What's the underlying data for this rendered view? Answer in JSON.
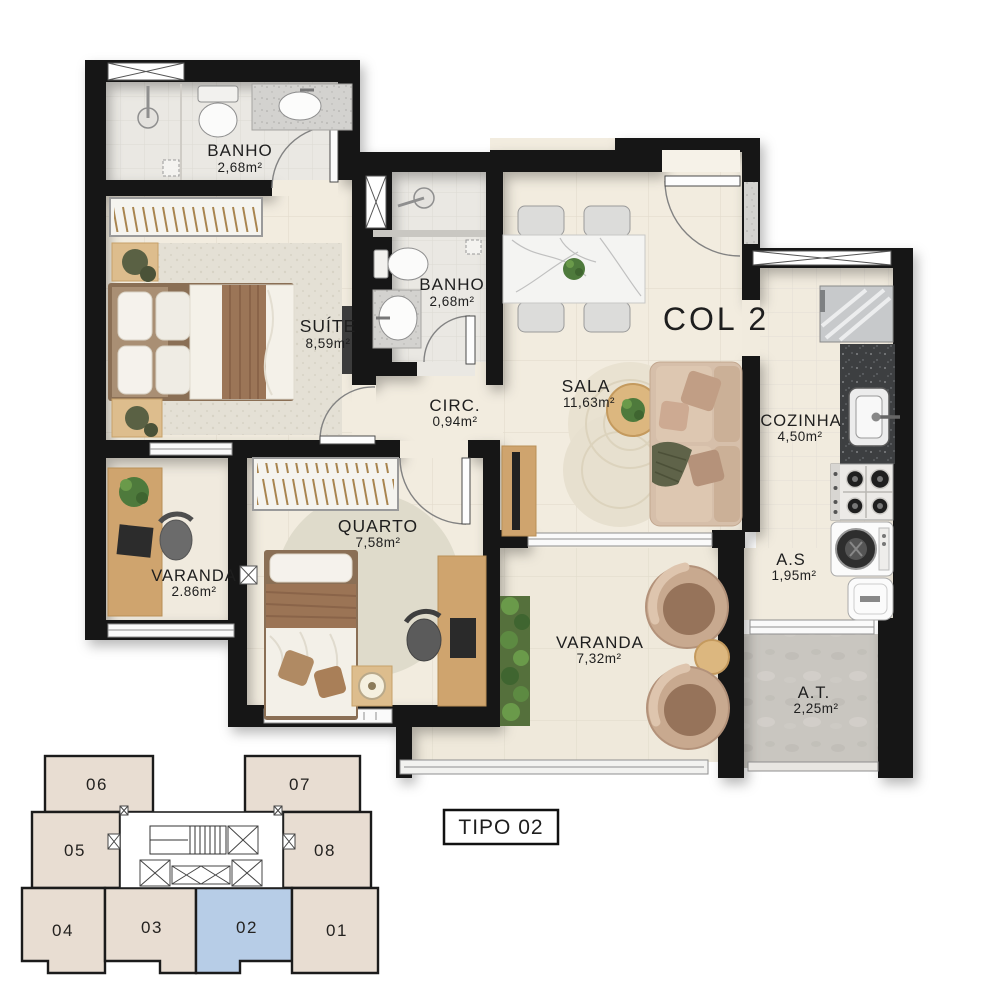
{
  "plan": {
    "type_label": "TIPO 02",
    "column_label": "COL 2",
    "rooms": [
      {
        "name": "BANHO",
        "area": "2,68m²"
      },
      {
        "name": "SUÍTE",
        "area": "8,59m²"
      },
      {
        "name": "BANHO",
        "area": "2,68m²"
      },
      {
        "name": "CIRC.",
        "area": "0,94m²"
      },
      {
        "name": "SALA",
        "area": "11,63m²"
      },
      {
        "name": "COZINHA",
        "area": "4,50m²"
      },
      {
        "name": "VARANDA",
        "area": "2.86m²"
      },
      {
        "name": "QUARTO",
        "area": "7,58m²"
      },
      {
        "name": "VARANDA",
        "area": "7,32m²"
      },
      {
        "name": "A.S",
        "area": "1,95m²"
      },
      {
        "name": "A.T.",
        "area": "2,25m²"
      }
    ]
  },
  "key_plan": {
    "units": [
      {
        "label": "06"
      },
      {
        "label": "07"
      },
      {
        "label": "05"
      },
      {
        "label": "08"
      },
      {
        "label": "04"
      },
      {
        "label": "03"
      },
      {
        "label": "02"
      },
      {
        "label": "01"
      }
    ],
    "highlighted_unit": "02"
  },
  "colors": {
    "wall": "#171412",
    "floor_cream": "#f2ecdf",
    "floor_tile": "#eae8e3",
    "concrete": "#c9c6c0",
    "granite_dark": "#3d3f41",
    "wood": "#cfa46e",
    "keyplan_unit": "#e8ddd2",
    "keyplan_highlight": "#b7cde7"
  }
}
